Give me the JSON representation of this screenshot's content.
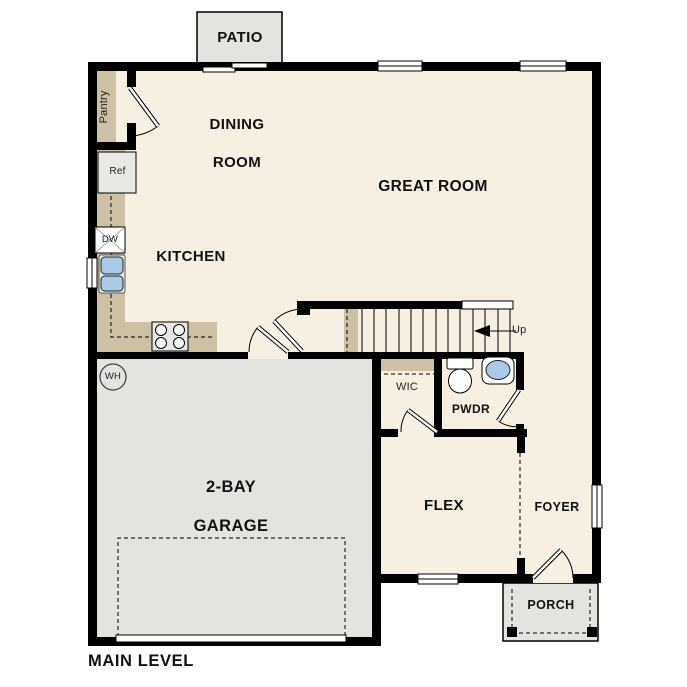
{
  "plan": {
    "footer_label": "MAIN LEVEL",
    "rooms": {
      "patio": "PATIO",
      "pantry": "Pantry",
      "dining_room": [
        "DINING",
        "ROOM"
      ],
      "great_room": "GREAT ROOM",
      "kitchen": "KITCHEN",
      "garage": [
        "2-BAY",
        "GARAGE"
      ],
      "wic": "WIC",
      "pwdr": "PWDR",
      "flex": "FLEX",
      "foyer": "FOYER",
      "porch": "PORCH"
    },
    "fixtures": {
      "refrigerator": "Ref",
      "dishwasher": "DW",
      "water_heater": "WH"
    },
    "stairs": {
      "direction": "Up"
    },
    "colors": {
      "floor": "#f7efe2",
      "hard": "#e3e3df",
      "counter": "#ccc0a5",
      "sinkblue": "#a9c9e9",
      "wall": "#000000",
      "ink": "#111111"
    }
  }
}
